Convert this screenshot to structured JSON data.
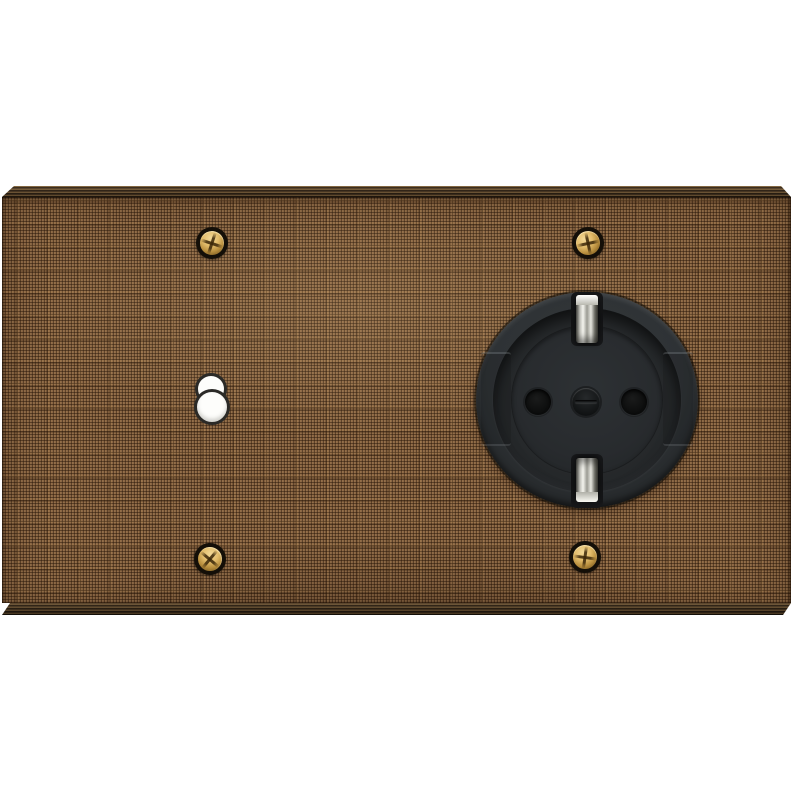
{
  "meta": {
    "type": "product-photo",
    "description": "Two-gang wall plate in woven-textile bronze finish with a toggle-lever cutout on the left, an anthracite Schuko power socket on the right, and four brass Phillips mounting screws on a white background."
  },
  "plate": {
    "finish": "woven-textile bronze",
    "gang_count": 2,
    "edges": "dark brushed bevel top and bottom"
  },
  "components": {
    "mounting_screws": {
      "count": 4,
      "finish": "brass",
      "drive": "phillips",
      "ring": "black washer ring"
    },
    "toggle_cutout": {
      "shape": "two overlapping circles",
      "fill": "white",
      "outline": "dark"
    },
    "socket": {
      "standard": "schuko",
      "color": "anthracite",
      "features": [
        "earth-clip-top",
        "earth-clip-bottom",
        "pin-hole-left",
        "pin-hole-right",
        "center-screw",
        "side-guide-notches"
      ]
    }
  },
  "colors": {
    "background": "#ffffff",
    "plate_base": "#8a6745",
    "weave_dark": "#33210f",
    "weave_light": "#c89c5f",
    "bevel": "#4a3824",
    "bevel_dark": "#2e2214",
    "brass_light": "#f2d896",
    "brass_dark": "#7b5a20",
    "screw_ring": "#140f08",
    "socket_body": "#2e3235",
    "socket_well": "#26292b",
    "socket_floor": "#282b2e",
    "clip_light": "#f4f4ee",
    "clip_dark": "#4f4f49",
    "hole_black": "#0b0c0c",
    "white_dot": "#fdfdfb",
    "outline_dark": "#2b2a27"
  }
}
